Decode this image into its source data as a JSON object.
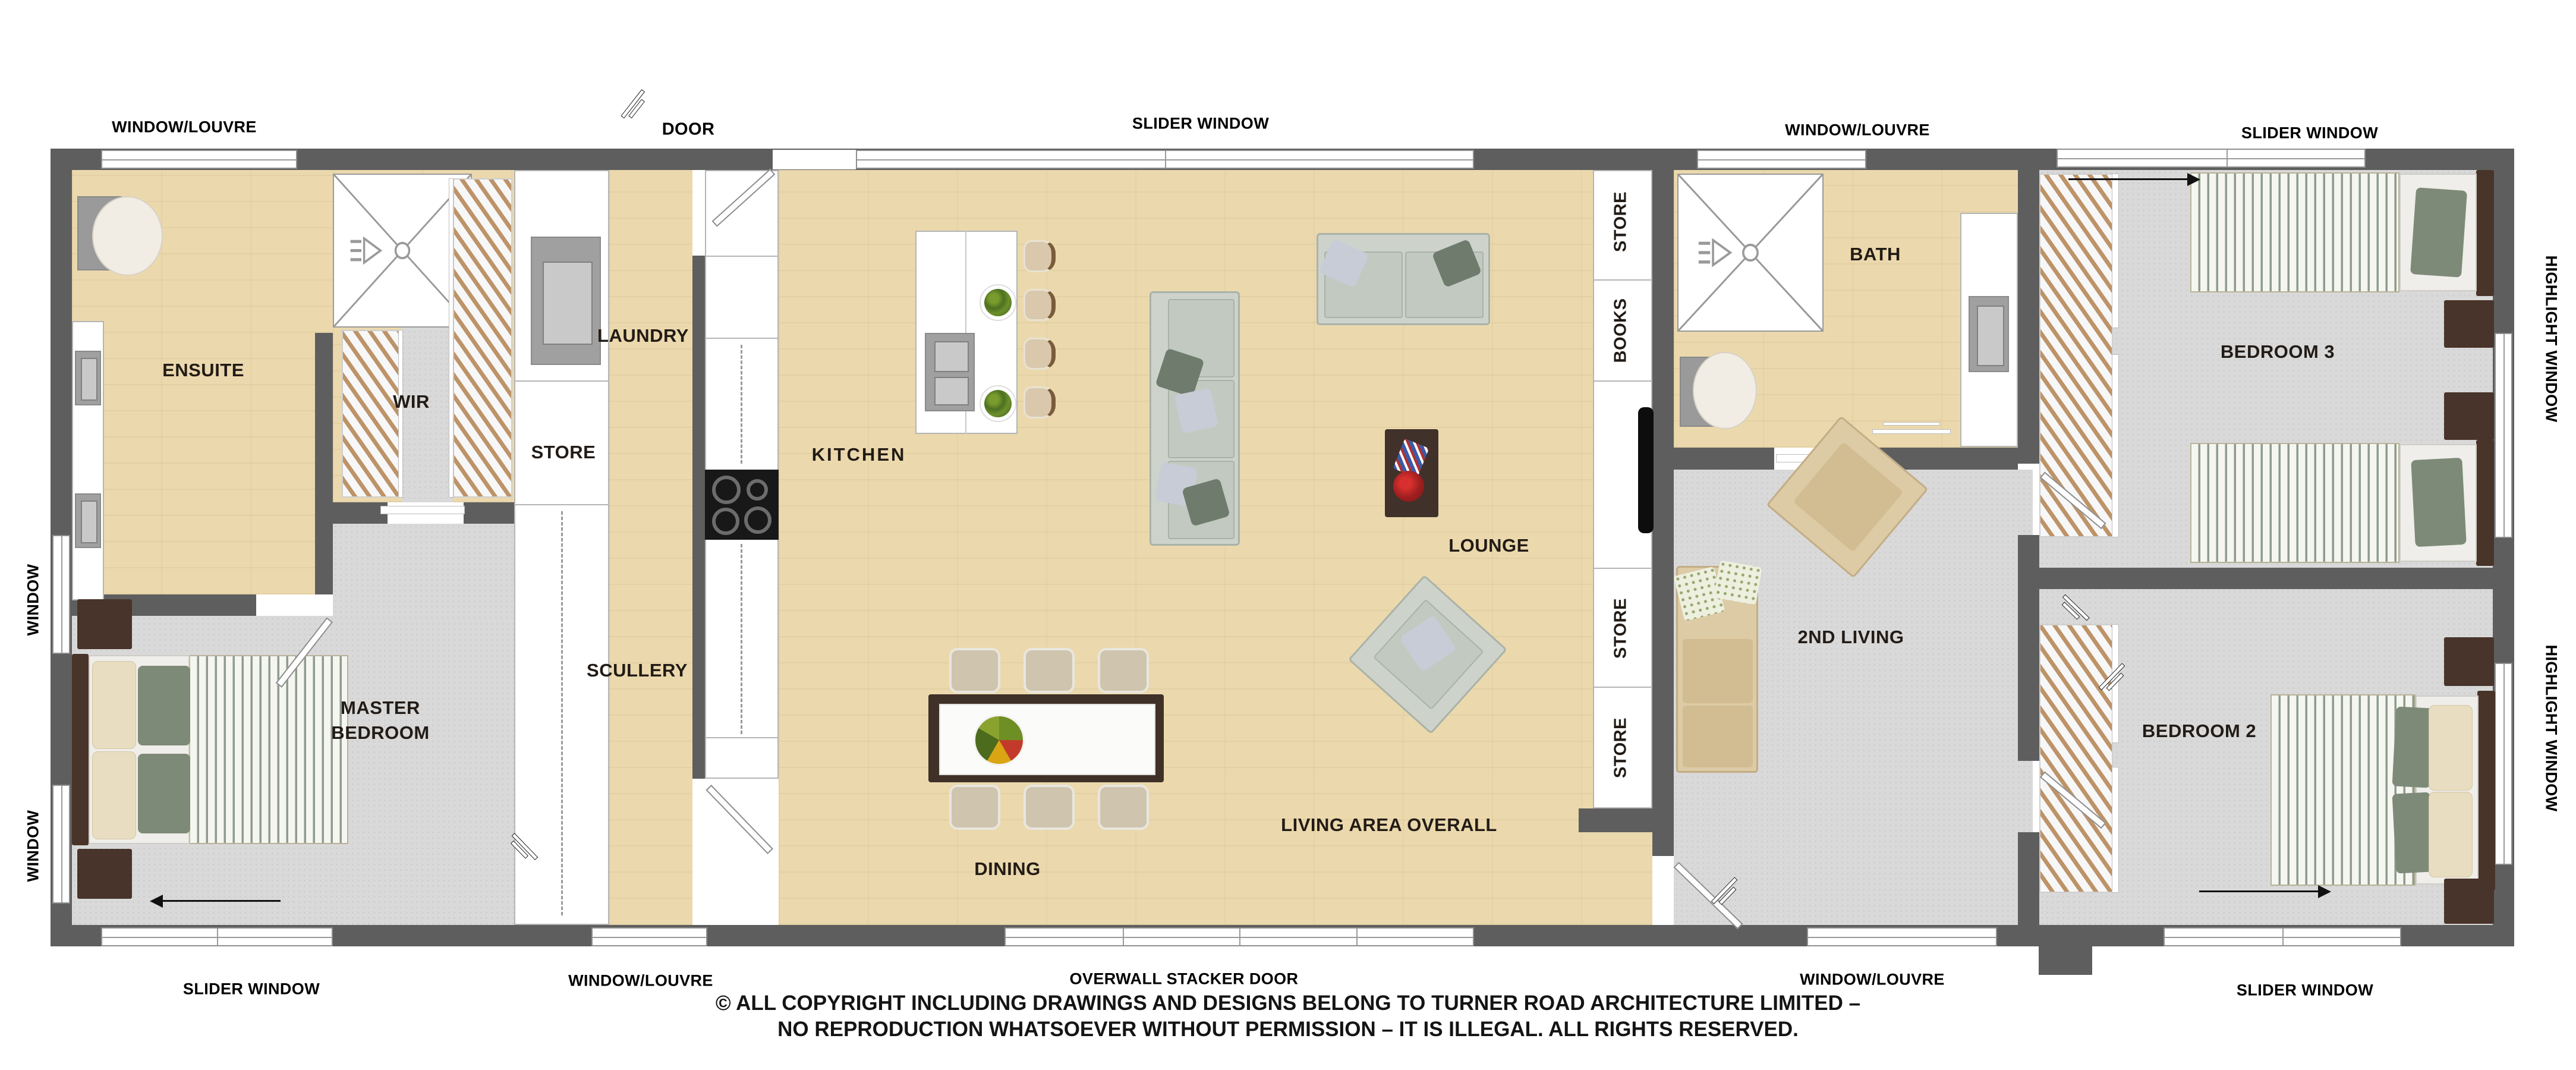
{
  "plan": {
    "rooms": {
      "ensuite": "ENSUITE",
      "wir": "WIR",
      "master": "MASTER\nBEDROOM",
      "laundry": "LAUNDRY",
      "store_hall": "STORE",
      "scullery": "SCULLERY",
      "kitchen": "KITCHEN",
      "dining": "DINING",
      "lounge": "LOUNGE",
      "living_overall": "LIVING AREA OVERALL",
      "store_top": "STORE",
      "books": "BOOKS",
      "store_mid": "STORE",
      "store_bottom": "STORE",
      "bath": "BATH",
      "second_living": "2ND LIVING",
      "bedroom3": "BEDROOM 3",
      "bedroom2": "BEDROOM 2"
    },
    "openings": {
      "top_window_louvre_left": "WINDOW/LOUVRE",
      "top_door": "DOOR",
      "top_slider": "SLIDER WINDOW",
      "top_window_louvre_right": "WINDOW/LOUVRE",
      "top_slider_bed3": "SLIDER WINDOW",
      "left_window_upper": "WINDOW",
      "left_window_lower": "WINDOW",
      "right_highlight_bed3": "HIGHLIGHT WINDOW",
      "right_highlight_bed2": "HIGHLIGHT WINDOW",
      "bottom_slider_master": "SLIDER WINDOW",
      "bottom_window_louvre_left": "WINDOW/LOUVRE",
      "bottom_stacker": "OVERWALL STACKER DOOR",
      "bottom_window_louvre_right": "WINDOW/LOUVRE",
      "bottom_slider_bed2": "SLIDER WINDOW"
    },
    "copyright": {
      "line1": "© ALL COPYRIGHT INCLUDING DRAWINGS AND DESIGNS BELONG TO TURNER ROAD ARCHITECTURE LIMITED –",
      "line2": "NO REPRODUCTION WHATSOEVER WITHOUT PERMISSION – IT IS ILLEGAL. ALL RIGHTS RESERVED."
    },
    "colors": {
      "wall": "#5e5e5e",
      "wood_floor": "#ebd9ad",
      "carpet": "#d9d9d9",
      "label_text": "#221b16",
      "sofa_gray": "#cdd3cb",
      "sofa_tan": "#ddcba6",
      "bed_stripe_green": "#8f9b8d",
      "timber_dark": "#483429",
      "appliance_black": "#181818"
    }
  }
}
